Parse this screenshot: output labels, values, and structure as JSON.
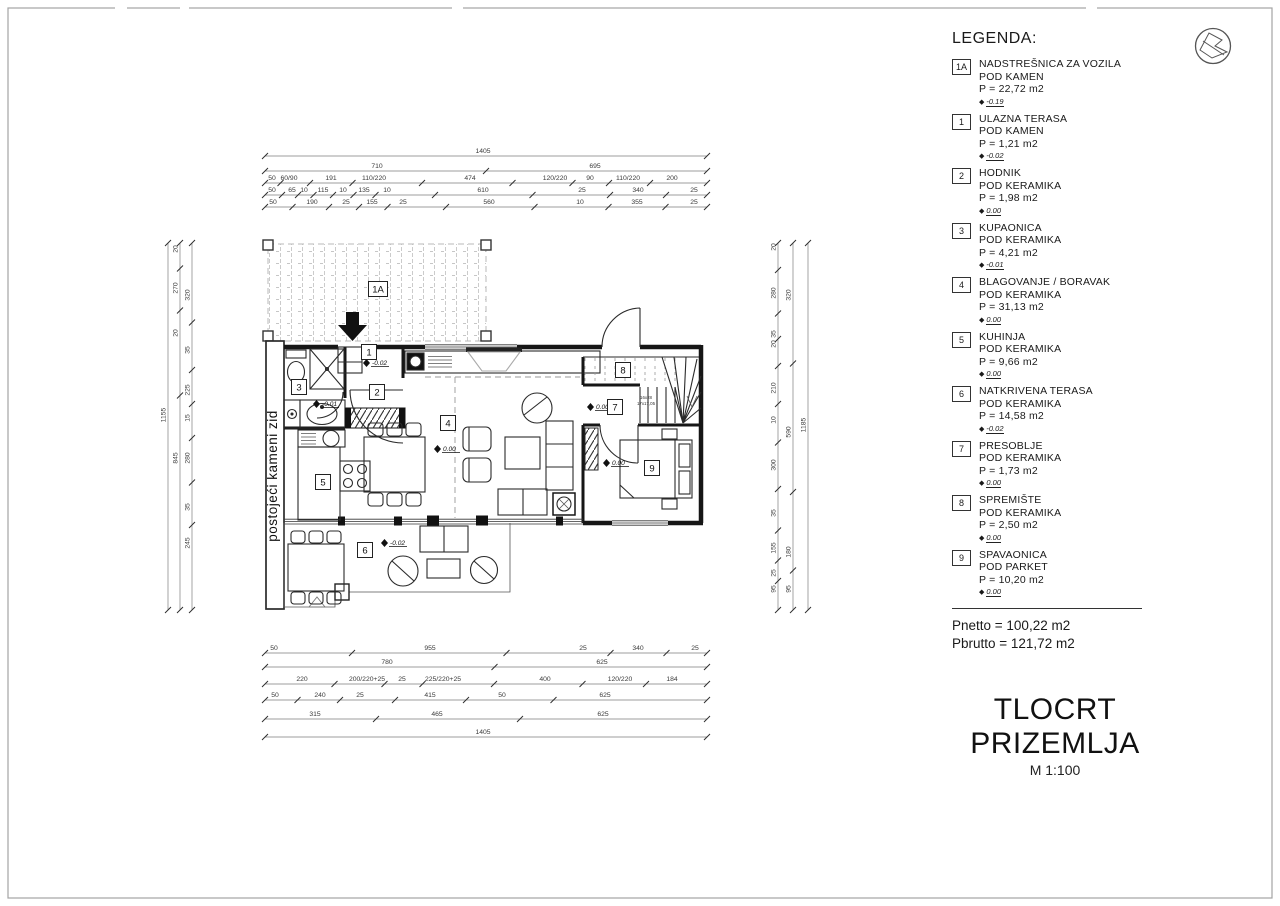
{
  "drawing": {
    "title": "TLOCRT PRIZEMLJA",
    "scale": "M 1:100"
  },
  "legend": {
    "heading": "LEGENDA:",
    "items": [
      {
        "num": "1A",
        "name": "NADSTREŠNICA ZA VOZILA",
        "floor": "POD KAMEN",
        "area": "P = 22,72 m2",
        "level": "-0.19"
      },
      {
        "num": "1",
        "name": "ULAZNA TERASA",
        "floor": "POD KAMEN",
        "area": "P = 1,21 m2",
        "level": "-0.02"
      },
      {
        "num": "2",
        "name": "HODNIK",
        "floor": "POD KERAMIKA",
        "area": "P = 1,98 m2",
        "level": "0.00"
      },
      {
        "num": "3",
        "name": "KUPAONICA",
        "floor": "POD KERAMIKA",
        "area": "P = 4,21 m2",
        "level": "-0.01"
      },
      {
        "num": "4",
        "name": "BLAGOVANJE / BORAVAK",
        "floor": "POD KERAMIKA",
        "area": "P = 31,13 m2",
        "level": "0.00"
      },
      {
        "num": "5",
        "name": "KUHINJA",
        "floor": "POD KERAMIKA",
        "area": "P = 9,66 m2",
        "level": "0.00"
      },
      {
        "num": "6",
        "name": "NATKRIVENA TERASA",
        "floor": "POD KERAMIKA",
        "area": "P = 14,58 m2",
        "level": "-0.02"
      },
      {
        "num": "7",
        "name": "PRESOBLJE",
        "floor": "POD KERAMIKA",
        "area": "P = 1,73 m2",
        "level": "0.00"
      },
      {
        "num": "8",
        "name": "SPREMIŠTE",
        "floor": "POD KERAMIKA",
        "area": "P = 2,50 m2",
        "level": "0.00"
      },
      {
        "num": "9",
        "name": "SPAVAONICA",
        "floor": "POD PARKET",
        "area": "P = 10,20 m2",
        "level": "0.00"
      }
    ],
    "totals": {
      "netto": "Pnetto = 100,22 m2",
      "brutto": "Pbrutto = 121,72 m2"
    }
  },
  "plan": {
    "wall_note": "postojeći kameni zid",
    "stair_note_1": "16x28",
    "stair_note_2": "17x17,05",
    "tags": [
      {
        "t": "1A",
        "x": 378,
        "y": 289
      },
      {
        "t": "1",
        "x": 369,
        "y": 352
      },
      {
        "t": "2",
        "x": 377,
        "y": 392
      },
      {
        "t": "3",
        "x": 299,
        "y": 387
      },
      {
        "t": "4",
        "x": 448,
        "y": 423
      },
      {
        "t": "5",
        "x": 323,
        "y": 482
      },
      {
        "t": "6",
        "x": 365,
        "y": 550
      },
      {
        "t": "7",
        "x": 615,
        "y": 407
      },
      {
        "t": "8",
        "x": 623,
        "y": 370
      },
      {
        "t": "9",
        "x": 652,
        "y": 468
      }
    ],
    "levels": [
      {
        "t": "-0.02",
        "x": 372,
        "y": 363
      },
      {
        "t": "-0.01",
        "x": 322,
        "y": 404
      },
      {
        "t": "0.00",
        "x": 443,
        "y": 449
      },
      {
        "t": "0.00",
        "x": 596,
        "y": 407
      },
      {
        "t": "0.00",
        "x": 612,
        "y": 463
      },
      {
        "t": "-0.02",
        "x": 390,
        "y": 543
      }
    ]
  },
  "dimensions": {
    "top_rows": [
      {
        "y": 153,
        "items": [
          {
            "t": "1405",
            "x": 483
          }
        ]
      },
      {
        "y": 168,
        "items": [
          {
            "t": "710",
            "x": 377
          },
          {
            "t": "695",
            "x": 595
          }
        ]
      },
      {
        "y": 180,
        "items": [
          {
            "t": "50",
            "x": 272
          },
          {
            "t": "60/90",
            "x": 289
          },
          {
            "t": "191",
            "x": 331
          },
          {
            "t": "110/220",
            "x": 374
          },
          {
            "t": "474",
            "x": 470
          },
          {
            "t": "120/220",
            "x": 555
          },
          {
            "t": "90",
            "x": 590
          },
          {
            "t": "110/220",
            "x": 628
          },
          {
            "t": "200",
            "x": 672
          }
        ]
      },
      {
        "y": 192,
        "items": [
          {
            "t": "50",
            "x": 272
          },
          {
            "t": "65",
            "x": 292
          },
          {
            "t": "10",
            "x": 304
          },
          {
            "t": "115",
            "x": 323
          },
          {
            "t": "10",
            "x": 343
          },
          {
            "t": "135",
            "x": 364
          },
          {
            "t": "10",
            "x": 387
          },
          {
            "t": "610",
            "x": 483
          },
          {
            "t": "25",
            "x": 582
          },
          {
            "t": "340",
            "x": 638
          },
          {
            "t": "25",
            "x": 694
          }
        ]
      },
      {
        "y": 204,
        "items": [
          {
            "t": "50",
            "x": 273
          },
          {
            "t": "190",
            "x": 312
          },
          {
            "t": "25",
            "x": 346
          },
          {
            "t": "155",
            "x": 372
          },
          {
            "t": "25",
            "x": 403
          },
          {
            "t": "560",
            "x": 489
          },
          {
            "t": "10",
            "x": 580
          },
          {
            "t": "355",
            "x": 637
          },
          {
            "t": "25",
            "x": 694
          }
        ]
      }
    ],
    "bottom_rows": [
      {
        "y": 650,
        "items": [
          {
            "t": "50",
            "x": 274
          },
          {
            "t": "955",
            "x": 430
          },
          {
            "t": "25",
            "x": 583
          },
          {
            "t": "340",
            "x": 638
          },
          {
            "t": "25",
            "x": 695
          }
        ]
      },
      {
        "y": 664,
        "items": [
          {
            "t": "780",
            "x": 387
          },
          {
            "t": "625",
            "x": 602
          }
        ]
      },
      {
        "y": 681,
        "items": [
          {
            "t": "220",
            "x": 302
          },
          {
            "t": "200/220+25",
            "x": 367
          },
          {
            "t": "25",
            "x": 402
          },
          {
            "t": "225/220+25",
            "x": 443
          },
          {
            "t": "400",
            "x": 545
          },
          {
            "t": "120/220",
            "x": 620
          },
          {
            "t": "184",
            "x": 672
          }
        ]
      },
      {
        "y": 697,
        "items": [
          {
            "t": "50",
            "x": 275
          },
          {
            "t": "240",
            "x": 320
          },
          {
            "t": "25",
            "x": 360
          },
          {
            "t": "415",
            "x": 430
          },
          {
            "t": "50",
            "x": 502
          },
          {
            "t": "625",
            "x": 605
          }
        ]
      },
      {
        "y": 716,
        "items": [
          {
            "t": "315",
            "x": 315
          },
          {
            "t": "465",
            "x": 437
          },
          {
            "t": "625",
            "x": 603
          }
        ]
      },
      {
        "y": 734,
        "items": [
          {
            "t": "1405",
            "x": 483
          }
        ]
      }
    ],
    "left_cols": [
      {
        "x": 168,
        "items": [
          {
            "t": "1155",
            "y": 415
          }
        ]
      },
      {
        "x": 180,
        "items": [
          {
            "t": "20",
            "y": 249
          },
          {
            "t": "270",
            "y": 288
          },
          {
            "t": "20",
            "y": 333
          },
          {
            "t": "845",
            "y": 458
          }
        ]
      },
      {
        "x": 192,
        "items": [
          {
            "t": "320",
            "y": 295
          },
          {
            "t": "35",
            "y": 350
          },
          {
            "t": "225",
            "y": 390
          },
          {
            "t": "15",
            "y": 418
          },
          {
            "t": "280",
            "y": 458
          },
          {
            "t": "35",
            "y": 507
          },
          {
            "t": "245",
            "y": 543
          }
        ]
      }
    ],
    "right_cols": [
      {
        "x": 778,
        "items": [
          {
            "t": "20",
            "y": 247
          },
          {
            "t": "280",
            "y": 293
          },
          {
            "t": "35",
            "y": 334
          },
          {
            "t": "20",
            "y": 344
          },
          {
            "t": "210",
            "y": 388
          },
          {
            "t": "10",
            "y": 420
          },
          {
            "t": "300",
            "y": 465
          },
          {
            "t": "35",
            "y": 513
          },
          {
            "t": "155",
            "y": 548
          },
          {
            "t": "25",
            "y": 573
          },
          {
            "t": "95",
            "y": 589
          }
        ]
      },
      {
        "x": 793,
        "items": [
          {
            "t": "320",
            "y": 295
          },
          {
            "t": "590",
            "y": 432
          },
          {
            "t": "180",
            "y": 552
          },
          {
            "t": "95",
            "y": 589
          }
        ]
      },
      {
        "x": 808,
        "items": [
          {
            "t": "1185",
            "y": 425
          }
        ]
      }
    ]
  }
}
